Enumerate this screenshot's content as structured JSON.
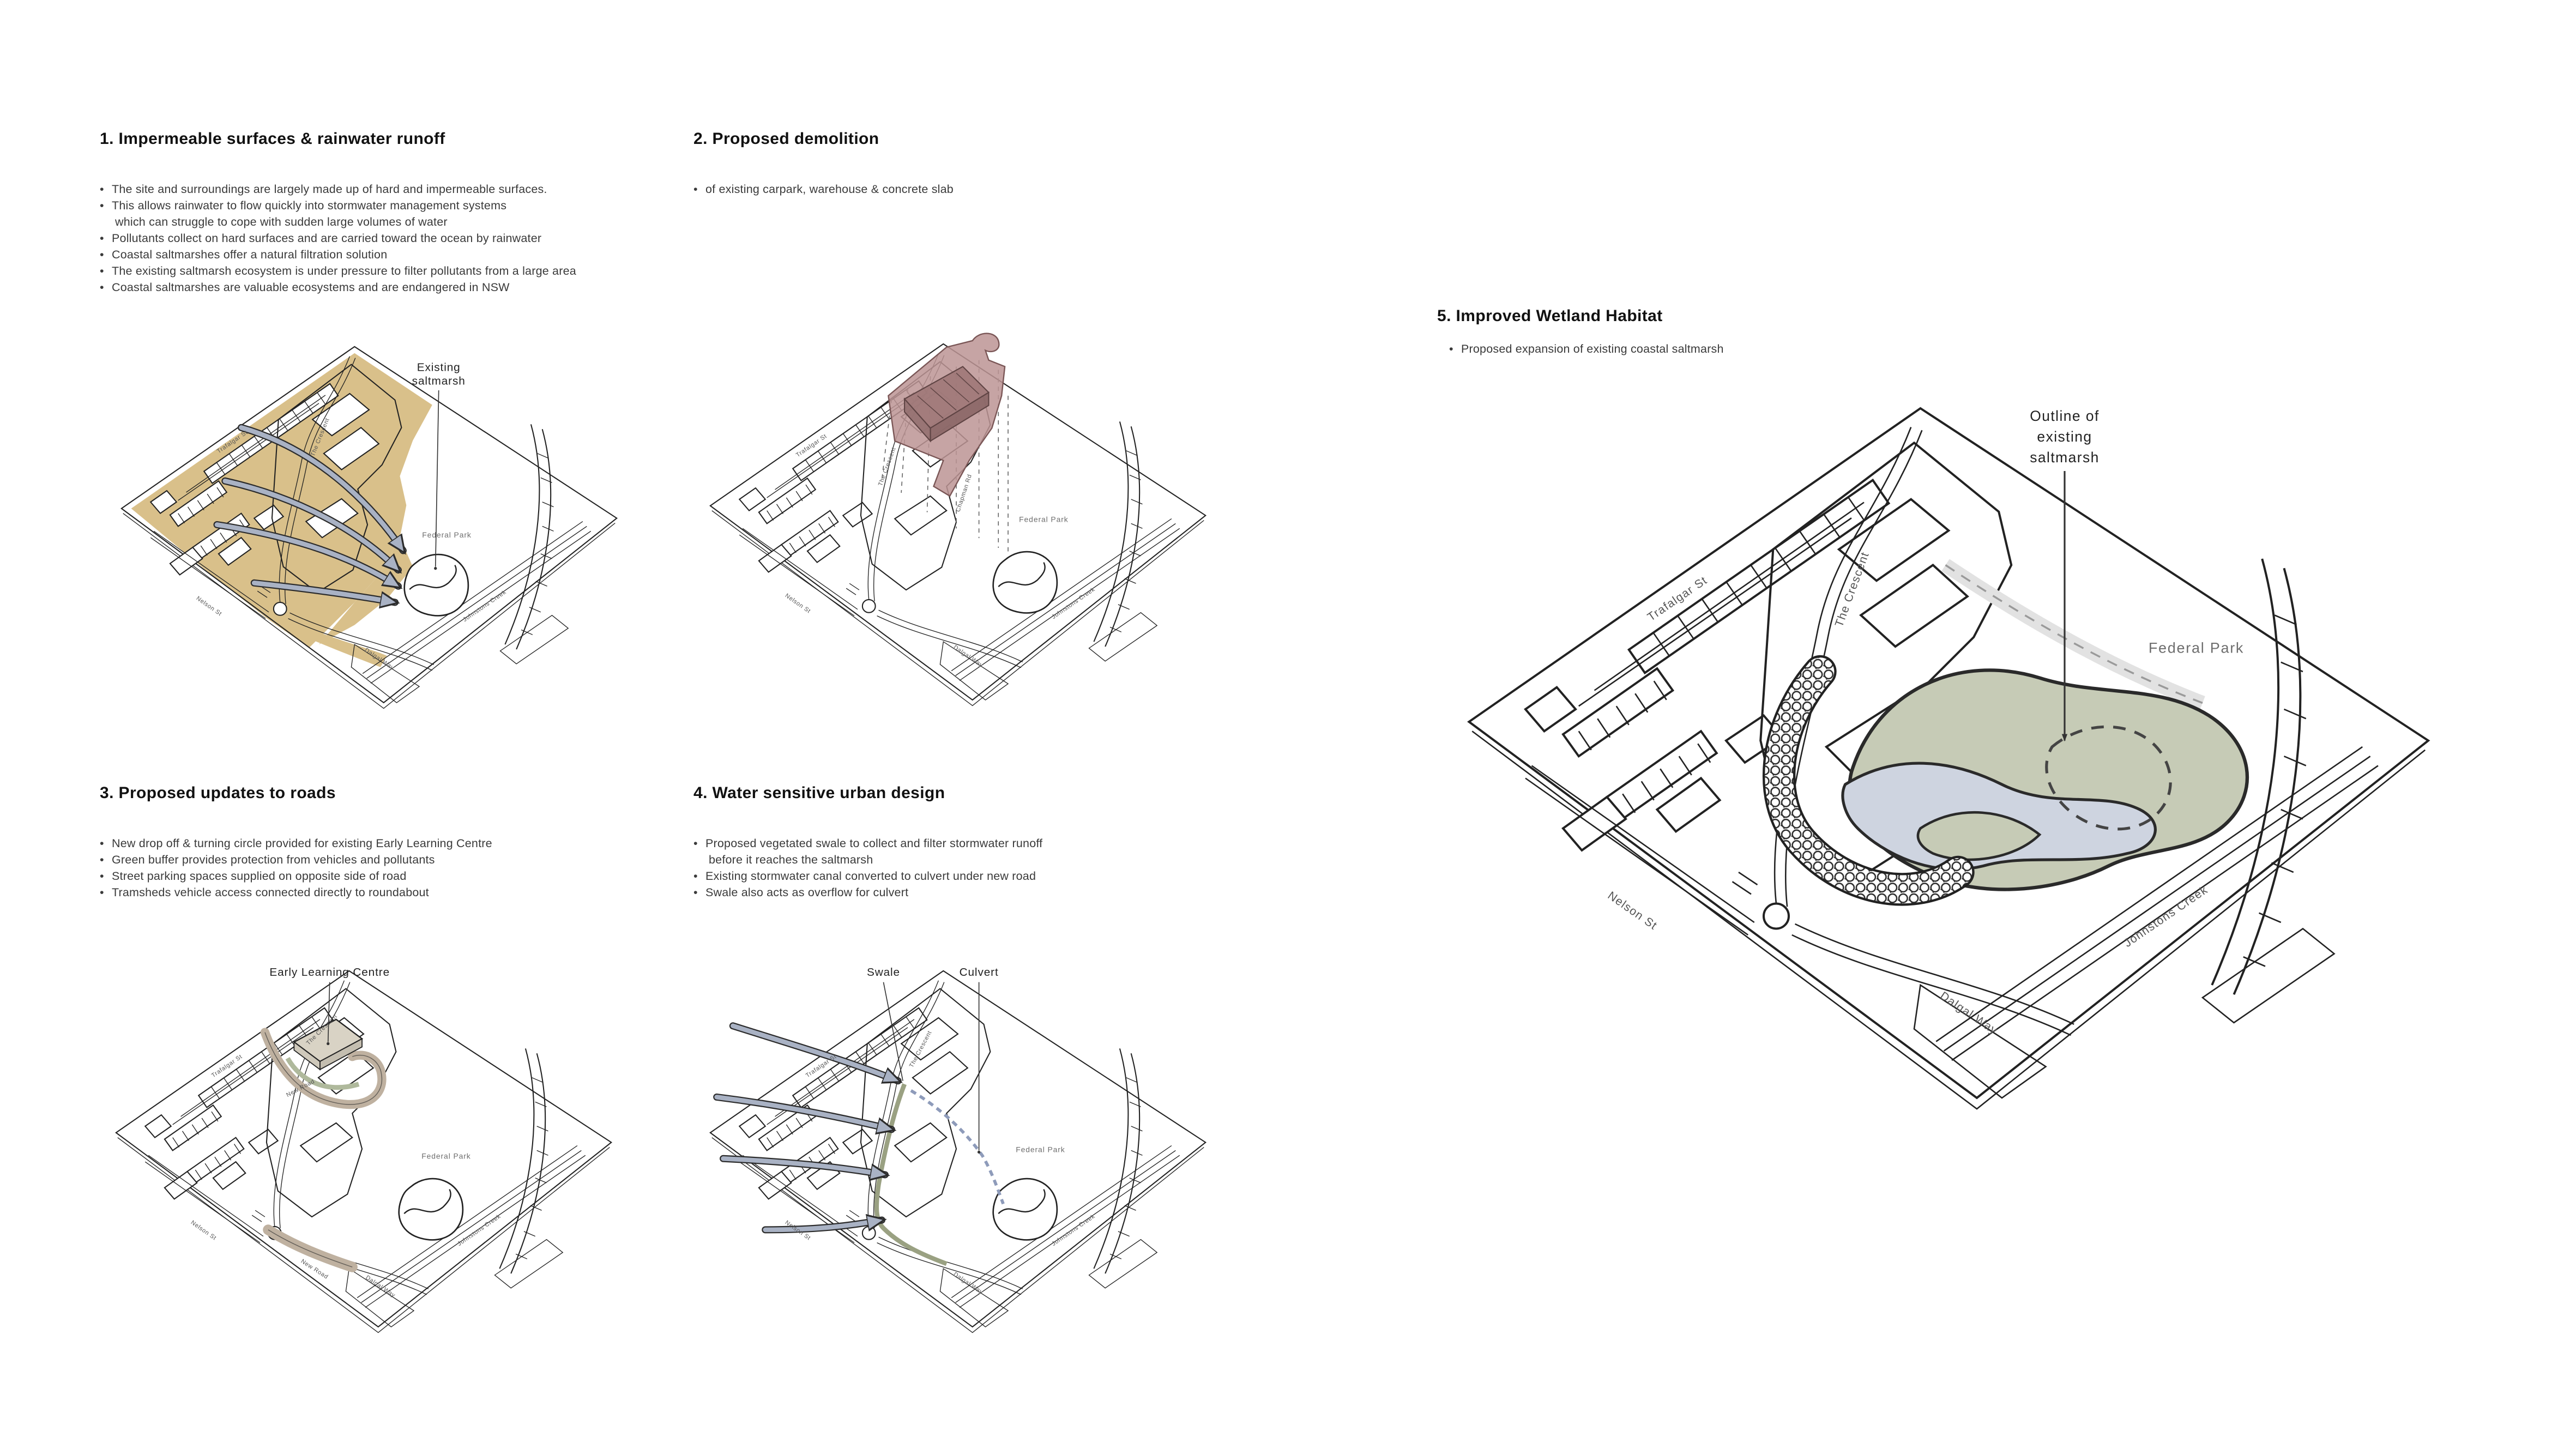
{
  "palette": {
    "impermeable_tan": "#D9C08A",
    "runoff_arrow_blue": "#A9B2C4",
    "demolition_mauve": "#BC9494",
    "demolition_dark": "#9E7878",
    "new_road_taupe": "#BFB1A0",
    "green_buffer": "#AFB99C",
    "elc_beige": "#D9D3C5",
    "marsh_green": "#C6CBB6",
    "marsh_blue": "#CED4E0",
    "swale_olive": "#9AA182",
    "culvert_blue": "#8E9BBA",
    "linework": "#222222"
  },
  "streets": {
    "trafalgar": "Trafalgar St",
    "crescent": "The Crescent",
    "nelson": "Nelson St",
    "dalgal": "Dalgal Way",
    "johnstons": "Johnstons Creek",
    "federal_park": "Federal Park",
    "chapman": "Chapman Rd",
    "new_road": "New Road"
  },
  "sections": {
    "s1": {
      "title": "1. Impermeable surfaces & rainwater runoff",
      "lines": [
        {
          "text": "The site and surroundings are largely made up of hard and impermeable surfaces.",
          "cont": false
        },
        {
          "text": "This allows rainwater to flow quickly into stormwater management systems",
          "cont": false
        },
        {
          "text": "which can struggle to cope with sudden large volumes of water",
          "cont": true
        },
        {
          "text": "Pollutants collect on hard surfaces and are carried toward the ocean by rainwater",
          "cont": false
        },
        {
          "text": "Coastal saltmarshes offer a natural filtration solution",
          "cont": false
        },
        {
          "text": "The existing saltmarsh ecosystem is under pressure to filter pollutants from a large area",
          "cont": false
        },
        {
          "text": "Coastal saltmarshes are valuable ecosystems and are endangered in NSW",
          "cont": false
        }
      ],
      "callout_line1": "Existing",
      "callout_line2": "saltmarsh"
    },
    "s2": {
      "title": "2. Proposed demolition",
      "lines": [
        {
          "text": "of existing carpark, warehouse & concrete slab",
          "cont": false
        }
      ]
    },
    "s3": {
      "title": "3. Proposed updates to roads",
      "lines": [
        {
          "text": "New drop off & turning circle provided for existing Early Learning Centre",
          "cont": false
        },
        {
          "text": "Green buffer provides protection from vehicles and pollutants",
          "cont": false
        },
        {
          "text": "Street parking spaces supplied on opposite side of road",
          "cont": false
        },
        {
          "text": "Tramsheds vehicle access connected directly to roundabout",
          "cont": false
        }
      ],
      "callout": "Early Learning Centre"
    },
    "s4": {
      "title": "4. Water sensitive urban design",
      "lines": [
        {
          "text": "Proposed vegetated swale to collect and filter stormwater runoff",
          "cont": false
        },
        {
          "text": "before it reaches the saltmarsh",
          "cont": true
        },
        {
          "text": "Existing stormwater canal converted to culvert under new road",
          "cont": false
        },
        {
          "text": "Swale also acts as overflow for culvert",
          "cont": false
        }
      ],
      "callout_swale": "Swale",
      "callout_culvert": "Culvert"
    },
    "s5": {
      "title": "5. Improved Wetland Habitat",
      "lines": [
        {
          "text": "Proposed expansion of existing coastal saltmarsh",
          "cont": false
        }
      ],
      "callout_line1": "Outline of",
      "callout_line2": "existing",
      "callout_line3": "saltmarsh"
    }
  }
}
